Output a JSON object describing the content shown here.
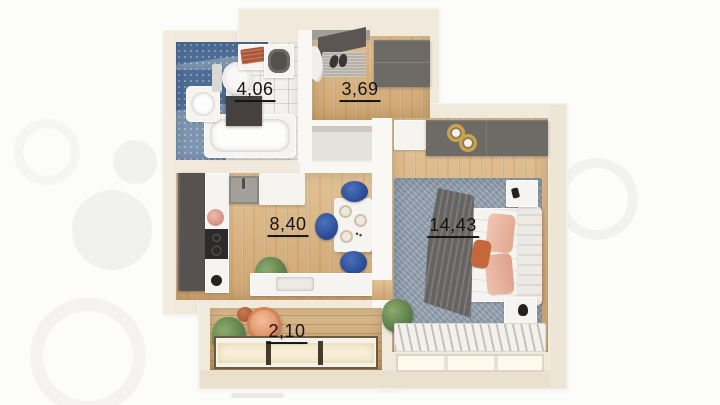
{
  "meta": {
    "description": "3D rendered floor plan of a one-bedroom apartment",
    "watermark_icon": "circles-logo-watermark"
  },
  "rooms": {
    "bathroom": {
      "name": "bathroom",
      "area_label": "4,06",
      "furniture": [
        "bathtub",
        "sink",
        "toilet",
        "washing-machine",
        "towel-shelf",
        "dark-cabinet",
        "blue-tile-walls"
      ]
    },
    "hallway": {
      "name": "hallway",
      "area_label": "3,69",
      "furniture": [
        "entry-door",
        "doormat",
        "shoes",
        "wardrobe",
        "coat-rack"
      ]
    },
    "kitchen": {
      "name": "kitchen",
      "area_label": "8,40",
      "furniture": [
        "tall-cabinet",
        "counter",
        "cooktop",
        "sink-unit",
        "upper-cabinets",
        "dining-table",
        "blue-chairs",
        "plant",
        "window-counter"
      ]
    },
    "bedroom": {
      "name": "bedroom",
      "area_label": "14,43",
      "furniture": [
        "wardrobe",
        "dresser",
        "double-bed",
        "pink-pillows",
        "gray-blanket",
        "nightstands",
        "rug",
        "radiator",
        "plant",
        "window"
      ]
    },
    "balcony": {
      "name": "balcony",
      "area_label": "2,10",
      "furniture": [
        "round-armchair",
        "plant",
        "planter-pot",
        "window"
      ]
    }
  },
  "colors": {
    "wall": "#f0e9dc",
    "wood_floor": "#d8b07a",
    "blue_tile": "#4d6d96",
    "dark_furniture": "#6e6a66",
    "chair_blue": "#2d54a1",
    "rug_gray_blue": "#93a0ad",
    "pillow_pink": "#ecbfae",
    "accent_orange": "#c4683c",
    "label_text": "#141414"
  }
}
